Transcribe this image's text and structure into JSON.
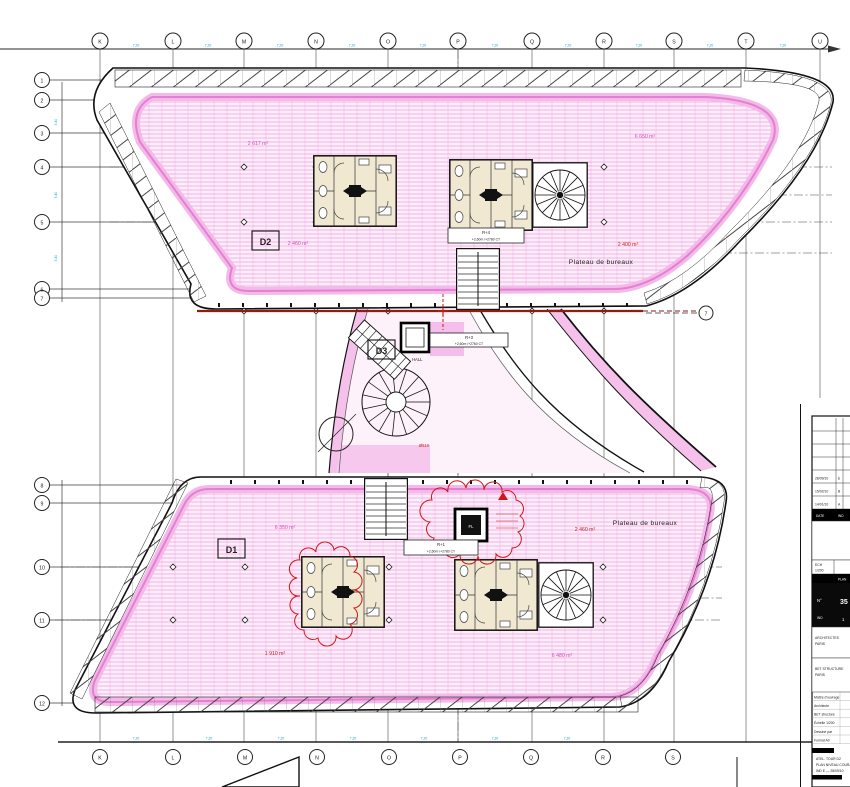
{
  "grid": {
    "top_letters": [
      "K",
      "L",
      "M",
      "N",
      "O",
      "P",
      "Q",
      "R",
      "S",
      "T",
      "U"
    ],
    "bottom_letters": [
      "K",
      "L",
      "M",
      "N",
      "O",
      "P",
      "Q",
      "R",
      "S"
    ],
    "left_upper_numbers": [
      "1",
      "2",
      "3",
      "4",
      "5",
      "6",
      "7"
    ],
    "left_lower_numbers": [
      "8",
      "9",
      "10",
      "11",
      "12"
    ],
    "right_number": "7",
    "top_dims": [
      "7,20",
      "7,20",
      "7,20",
      "7,20",
      "7,20",
      "7,20",
      "7,20",
      "7,20",
      "7,20",
      "7,20"
    ],
    "bottom_dims": [
      "7,20",
      "7,20",
      "7,20",
      "7,20",
      "7,20",
      "7,20",
      "7,20"
    ],
    "left_dims": [
      "5,40",
      "5,40",
      "5,40"
    ]
  },
  "zones": {
    "d2": "D2",
    "d1": "D1",
    "d3": "D3",
    "plateau_top": "Plateau de bureaux",
    "plateau_bottom": "Plateau de bureaux",
    "hall": "HALL"
  },
  "areas": {
    "upper_left": "2 617 m²",
    "upper_right": "6 650 m²",
    "upper_mid": "2 460 m²",
    "upper_red": "2 400 m²",
    "lower_left": "6 350 m²",
    "lower_red": "1 910 m²",
    "lower_mid_red": "2 460 m²",
    "lower_right": "6 480 m²"
  },
  "notes": {
    "box_upper_l1": "R+4",
    "box_upper_l2": "+2,60m /+2780 CT",
    "box_mid_l1": "R+3",
    "box_mid_l2": "+2,60m /+2760 CT",
    "box_lower_l1": "R+1",
    "box_lower_l2": "+2,60m /+2780 CT",
    "fl": "FL",
    "d610": "Ø610"
  },
  "titleblock": {
    "revisions": [
      {
        "date": "",
        "ind": ""
      },
      {
        "date": "",
        "ind": ""
      },
      {
        "date": "",
        "ind": ""
      },
      {
        "date": "",
        "ind": ""
      },
      {
        "date": "28/09/10",
        "ind": "E"
      },
      {
        "date": "15/02/10",
        "ind": "B"
      },
      {
        "date": "14/01/10",
        "ind": "A"
      }
    ],
    "rev_header_date": "DATE",
    "rev_header_ind": "IND",
    "scale_label": "ECH",
    "scale_value": "1/200",
    "bar1": "PLAN",
    "num_label": "N°",
    "num_value": "35",
    "ind_label": "IND",
    "ind_value": "1",
    "firm1": "ARCHITECTES",
    "firm1b": "PARIS",
    "firm2": "BET STRUCTURE",
    "firm2b": "PARIS",
    "side_rows": [
      "Maître d'ouvrage",
      "Architecte",
      "BET structure",
      "Échelle 1/200",
      "Dessiné par",
      "Format A0"
    ],
    "footer_lines": [
      "ATEL. TOUR D2",
      "PLAN NIVEAU COURANT",
      "IND E — 28/09/10"
    ]
  }
}
